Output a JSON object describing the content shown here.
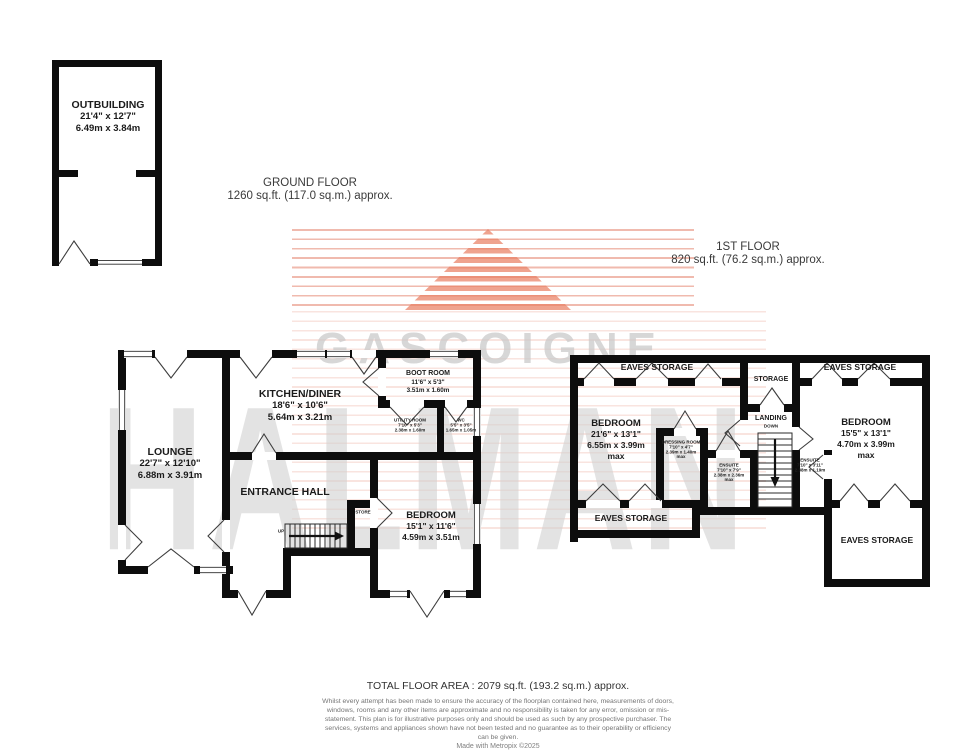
{
  "watermark": {
    "brand_line1": "GASCOIGNE",
    "brand_line2": "HALMAN"
  },
  "colors": {
    "watermark_stripe": "#e2765e",
    "watermark_text": "#cccccc",
    "wall": "#0d0d0d"
  },
  "headers": {
    "ground_floor": {
      "title": "GROUND FLOOR",
      "area": "1260 sq.ft. (117.0 sq.m.) approx."
    },
    "first_floor": {
      "title": "1ST FLOOR",
      "area": "820 sq.ft. (76.2 sq.m.) approx."
    }
  },
  "outbuilding": {
    "name": "OUTBUILDING",
    "imperial": "21'4\" x 12'7\"",
    "metric": "6.49m x 3.84m"
  },
  "ground_floor": {
    "lounge": {
      "name": "LOUNGE",
      "imperial": "22'7\" x 12'10\"",
      "metric": "6.88m x 3.91m"
    },
    "kitchen_diner": {
      "name": "KITCHEN/DINER",
      "imperial": "18'6\" x 10'6\"",
      "metric": "5.64m x 3.21m"
    },
    "boot_room": {
      "name": "BOOT ROOM",
      "imperial": "11'6\" x 5'3\"",
      "metric": "3.51m x 1.60m"
    },
    "utility_room": {
      "name": "UTILITY ROOM",
      "imperial": "7'10\" x 5'3\"",
      "metric": "2.38m x 1.60m"
    },
    "wc": {
      "name": "WC",
      "imperial": "5'5\" x 3'5\"",
      "metric": "1.65m x 1.05m"
    },
    "entrance_hall": {
      "name": "ENTRANCE HALL"
    },
    "bedroom": {
      "name": "BEDROOM",
      "imperial": "15'1\" x 11'6\"",
      "metric": "4.59m x 3.51m"
    },
    "store": {
      "name": "STORE"
    },
    "stairs_label": "UP"
  },
  "first_floor": {
    "eaves_storage_tl": {
      "name": "EAVES STORAGE"
    },
    "storage": {
      "name": "STORAGE"
    },
    "eaves_storage_tr": {
      "name": "EAVES STORAGE"
    },
    "bedroom_left": {
      "name": "BEDROOM",
      "imperial": "21'6\" x 13'1\"",
      "metric": "6.55m x 3.99m",
      "qualifier": "max"
    },
    "dressing_room": {
      "name": "DRESSING ROOM",
      "imperial": "7'10\" x 4'7\"",
      "metric": "2.39m x 1.40m",
      "qualifier": "max"
    },
    "ensuite": {
      "name": "ENSUITE",
      "imperial": "7'10\" x 7'9\"",
      "metric": "2.38m x 2.36m",
      "qualifier": "max"
    },
    "landing": {
      "name": "LANDING",
      "stairs_label": "DOWN"
    },
    "bedroom_right": {
      "name": "BEDROOM",
      "imperial": "15'5\" x 13'1\"",
      "metric": "4.70m x 3.99m",
      "qualifier": "max"
    },
    "ensuite_2": {
      "name": "ENSUITE",
      "imperial": "7'10\" x 3'11\"",
      "metric": "2.38m x 1.19m"
    },
    "eaves_storage_bl": {
      "name": "EAVES STORAGE"
    },
    "eaves_storage_br": {
      "name": "EAVES STORAGE"
    }
  },
  "footer": {
    "total_area": "TOTAL FLOOR AREA : 2079 sq.ft. (193.2 sq.m.) approx.",
    "disclaimer": "Whilst every attempt has been made to ensure the accuracy of the floorplan contained here, measurements of doors, windows, rooms and any other items are approximate and no responsibility is taken for any error, omission or mis-statement. This plan is for illustrative purposes only and should be used as such by any prospective purchaser. The services, systems and appliances shown have not been tested and no guarantee as to their operability or efficiency can be given.",
    "credit": "Made with Metropix ©2025"
  }
}
